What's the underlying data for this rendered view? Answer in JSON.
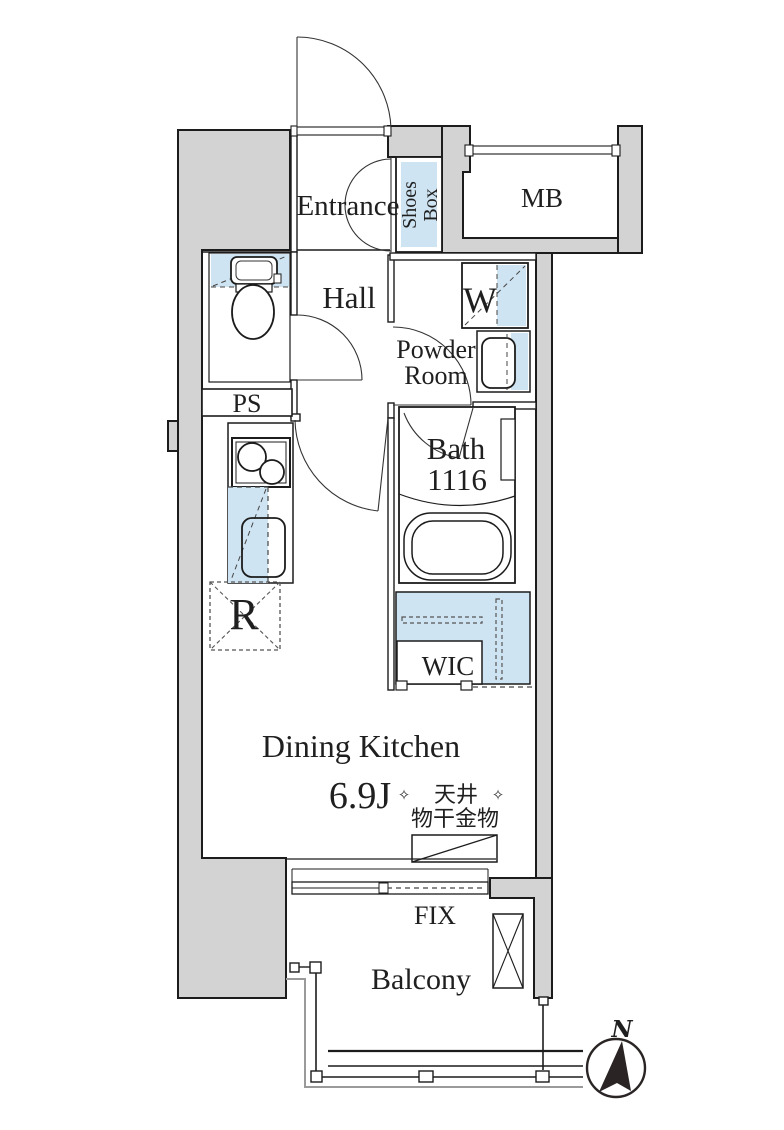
{
  "title": "Apartment floor plan",
  "colors": {
    "wall_fill": "#d3d3d3",
    "fixture_blue": "#cfe4f2",
    "outline": "#1c1c1c",
    "background": "#ffffff"
  },
  "labels": {
    "entrance": "Entrance",
    "shoes_box_line1": "Shoes",
    "shoes_box_line2": "Box",
    "mb": "MB",
    "hall": "Hall",
    "washer": "W",
    "powder_line1": "Powder",
    "powder_line2": "Room",
    "ps": "PS",
    "bath_name": "Bath",
    "bath_size": "1116",
    "wic": "WIC",
    "fridge": "R",
    "dining_kitchen": "Dining Kitchen",
    "dk_size": "6.9J",
    "ceiling_note_line1": "天井",
    "ceiling_note_line2": "物干金物",
    "ornament_left": "✧",
    "ornament_right": "✧",
    "fix": "FIX",
    "balcony": "Balcony",
    "compass_north": "N"
  }
}
